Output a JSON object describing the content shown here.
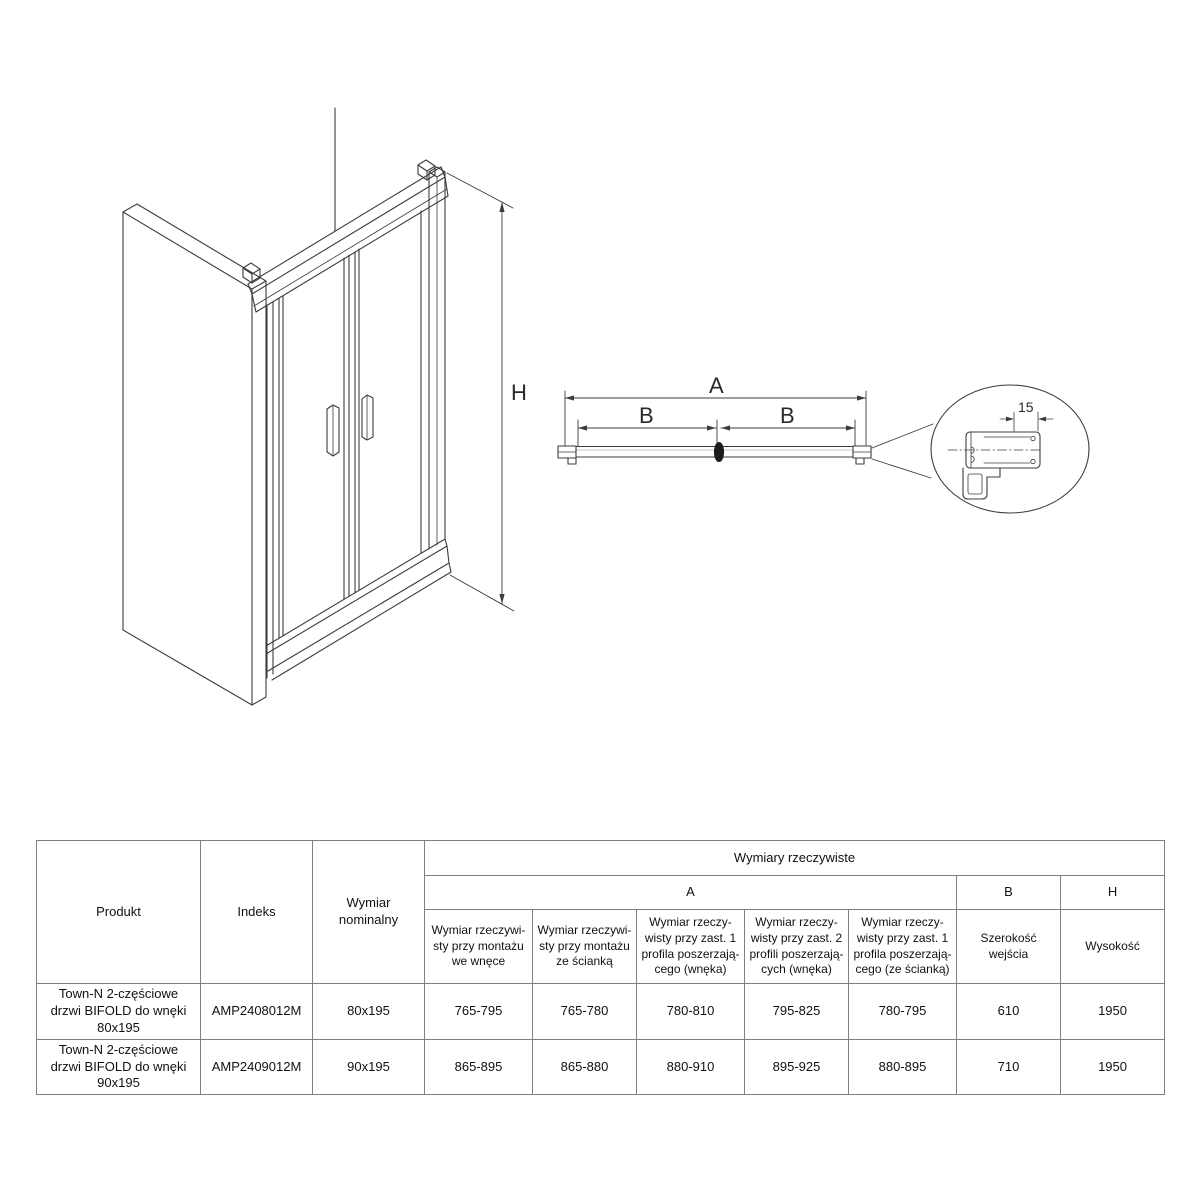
{
  "colors": {
    "line": "#3c3c3c",
    "table_border": "#7f7f7f",
    "text": "#1a1a1a",
    "background": "#ffffff",
    "hinge_fill": "#1c1c1c"
  },
  "diagram": {
    "height_label": "H",
    "width_total_label": "A",
    "width_left_label": "B",
    "width_right_label": "B",
    "detail_dimension": "15"
  },
  "table": {
    "headers": {
      "produkt": "Produkt",
      "indeks": "Indeks",
      "wymiar_nominalny": "Wymiar\nnominalny",
      "wymiary_rzeczywiste": "Wymiary rzeczywiste",
      "a": "A",
      "b": "B",
      "h": "H",
      "sub_a": [
        "Wymiar rzeczywi-\nsty przy montażu\nwe wnęce",
        "Wymiar rzeczywi-\nsty przy montażu\nze ścianką",
        "Wymiar rzeczy-\nwisty przy zast. 1\nprofila poszerzają-\ncego (wnęka)",
        "Wymiar rzeczy-\nwisty przy zast. 2\nprofili poszerzają-\ncych (wnęka)",
        "Wymiar rzeczy-\nwisty przy zast. 1\nprofila poszerzają-\ncego (ze ścianką)"
      ],
      "sub_b": "Szerokość wejścia",
      "sub_h": "Wysokość"
    },
    "rows": [
      {
        "produkt": "Town-N 2-częściowe\ndrzwi BIFOLD do wnęki\n80x195",
        "indeks": "AMP2408012M",
        "wymiar": "80x195",
        "values": [
          "765-795",
          "765-780",
          "780-810",
          "795-825",
          "780-795",
          "610",
          "1950"
        ]
      },
      {
        "produkt": "Town-N 2-częściowe\ndrzwi BIFOLD do wnęki\n90x195",
        "indeks": "AMP2409012M",
        "wymiar": "90x195",
        "values": [
          "865-895",
          "865-880",
          "880-910",
          "895-925",
          "880-895",
          "710",
          "1950"
        ]
      }
    ]
  }
}
